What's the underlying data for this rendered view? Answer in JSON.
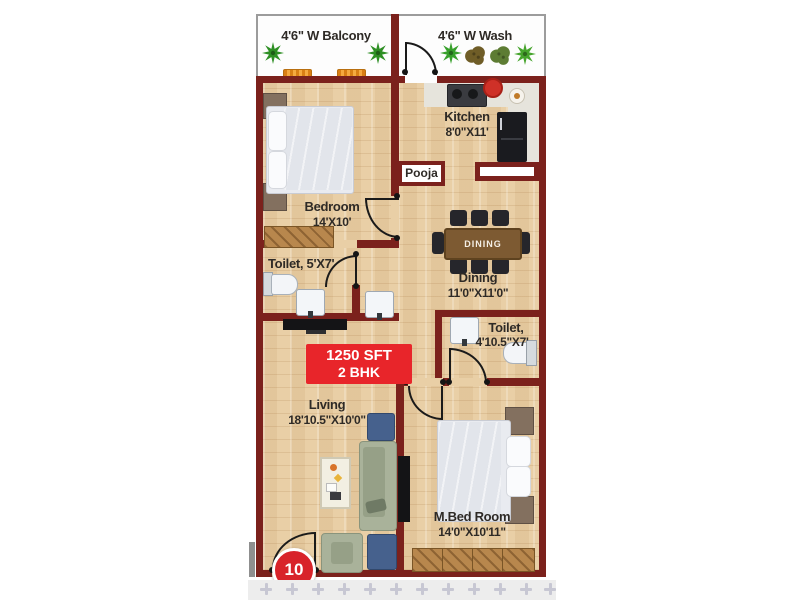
{
  "outdoor": {
    "balcony_label": "4'6\" W Balcony",
    "wash_label": "4'6\" W Wash"
  },
  "rooms": {
    "bedroom": {
      "name": "Bedroom",
      "dims": "14'X10'"
    },
    "kitchen": {
      "name": "Kitchen",
      "dims": "8'0\"X11'"
    },
    "pooja": {
      "name": "Pooja"
    },
    "dining": {
      "name": "Dining",
      "dims": "11'0\"X11'0\"",
      "table_text": "DINING"
    },
    "toilet1": {
      "name": "Toilet, 5'X7'"
    },
    "toilet2": {
      "name": "Toilet,",
      "dims": "4'10.5\"X7'"
    },
    "living": {
      "name": "Living",
      "dims": "18'10.5\"X10'0\""
    },
    "master_bedroom": {
      "name": "M.Bed Room",
      "dims": "14'0\"X10'11\""
    }
  },
  "badge": {
    "line1": "1250 SFT",
    "line2": "2 BHK"
  },
  "unit_marker": "10",
  "colors": {
    "wall": "#7b211c",
    "floor": "#e9cfa6",
    "badge_red": "#e8252a",
    "marker_red": "#d8232a",
    "counter": "#e6e4dc"
  }
}
